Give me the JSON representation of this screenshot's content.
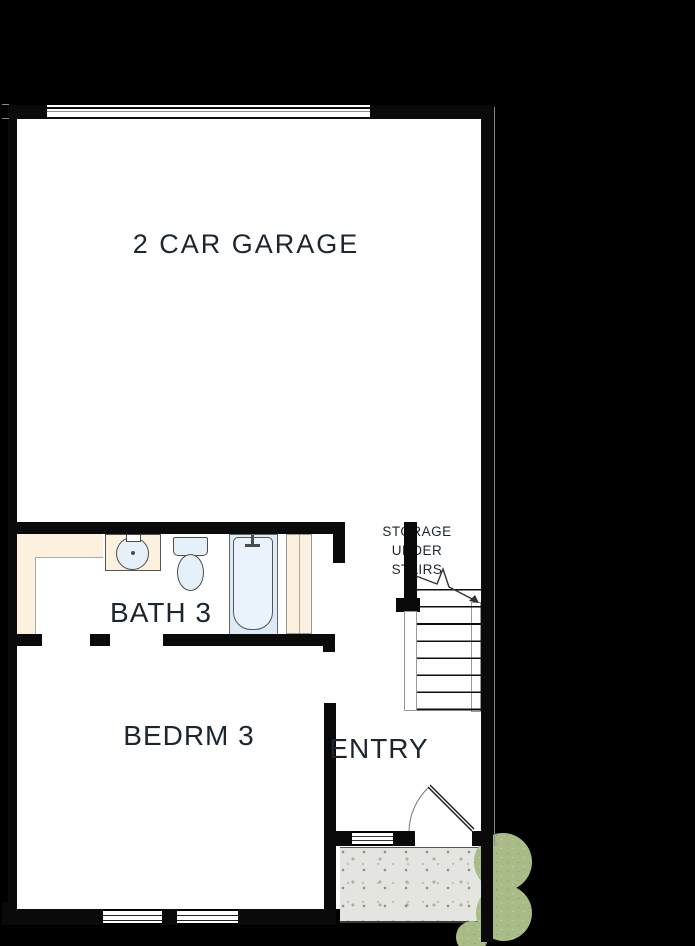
{
  "floorplan": {
    "rooms": [
      {
        "id": "garage",
        "label": "2 CAR GARAGE"
      },
      {
        "id": "bath",
        "label": "BATH 3"
      },
      {
        "id": "bedroom",
        "label": "BEDRM 3"
      },
      {
        "id": "entry",
        "label": "ENTRY"
      }
    ],
    "storage_label": {
      "line1": "STORAGE",
      "line2": "UNDER",
      "line3": "STAIRS"
    },
    "fixtures": [
      {
        "icon": "sink-icon"
      },
      {
        "icon": "toilet-icon"
      },
      {
        "icon": "bathtub-icon"
      },
      {
        "icon": "closet-shelves"
      },
      {
        "icon": "stairs"
      },
      {
        "icon": "stair-direction-arrow"
      },
      {
        "icon": "garage-door"
      },
      {
        "icon": "entry-door-swing"
      },
      {
        "icon": "sidelite-window"
      },
      {
        "icon": "bedroom-window"
      },
      {
        "icon": "porch-slab"
      },
      {
        "icon": "shrub-icon"
      }
    ],
    "colors": {
      "bg": "#000000",
      "floor": "#ffffff",
      "wall": "#0a0a0a",
      "cream": "#fbf1de",
      "tub-blue": "#dcebf7",
      "fixture-blue": "#e6f0f9",
      "fixture-line": "#4d4d4d",
      "porch-gray": "#e4e4e1",
      "porch-speck": "#8f8f88",
      "bush-green": "#a9bc88",
      "label-ink": "#1b2630",
      "ref-gray": "#8a8a8a"
    }
  }
}
